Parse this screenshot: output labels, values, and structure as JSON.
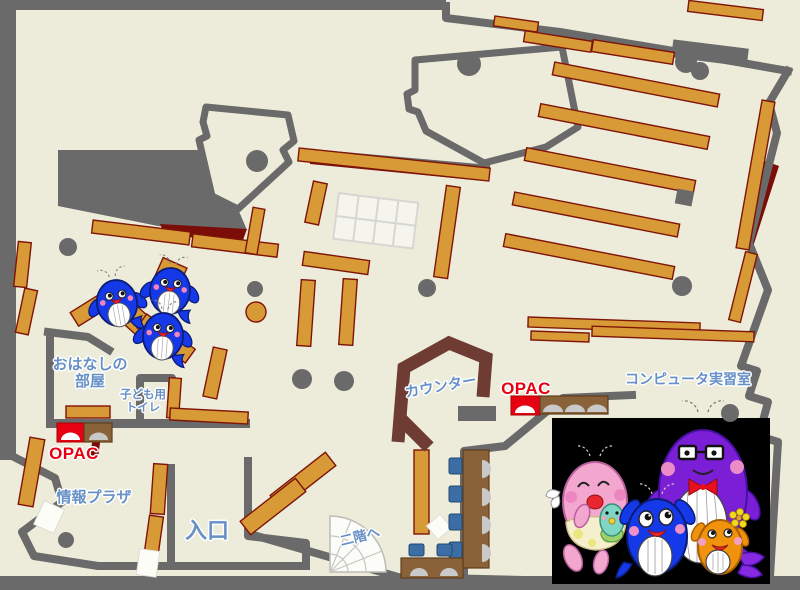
{
  "map": {
    "title": "library-floor-map",
    "labels": {
      "storytime_room": [
        "おはなしの",
        "部屋"
      ],
      "kids_toilet": [
        "子ども用",
        "トイレ"
      ],
      "opac_left": "OPAC",
      "opac_right": "OPAC",
      "info_plaza": "情報プラザ",
      "entrance": "入口",
      "counter": "カウンター",
      "stairs_up": "二階へ",
      "computer_room": "コンピュータ実習室"
    },
    "colors": {
      "floor": "#edecdb",
      "wall_gray": "#6a6a6a",
      "shelf_fill": "#d89a36",
      "shelf_border": "#7e1408",
      "dark_red": "#7a0d08",
      "counter_brown": "#6f3c34",
      "desk_brown": "#8a6239",
      "label_blue": "#6690c6",
      "opac_red": "#e60012",
      "chair_blue": "#3a6ea5",
      "seat_gray": "#c9c9c9",
      "photo_bg": "#000000",
      "whale_blue": "#1539e8",
      "whale_pink": "#f4a7ce",
      "whale_purple": "#7b1fd6",
      "whale_orange": "#f0920c",
      "whale_teal": "#7fd6c2"
    },
    "characters": {
      "kids_corner": [
        "whale-mascot-blue",
        "whale-mascot-blue",
        "whale-mascot-blue"
      ],
      "family_photo": [
        "whale-mascot-pink-mother",
        "whale-mascot-teal-baby",
        "whale-mascot-blue-child",
        "whale-mascot-purple-father",
        "whale-mascot-orange-child"
      ]
    }
  }
}
